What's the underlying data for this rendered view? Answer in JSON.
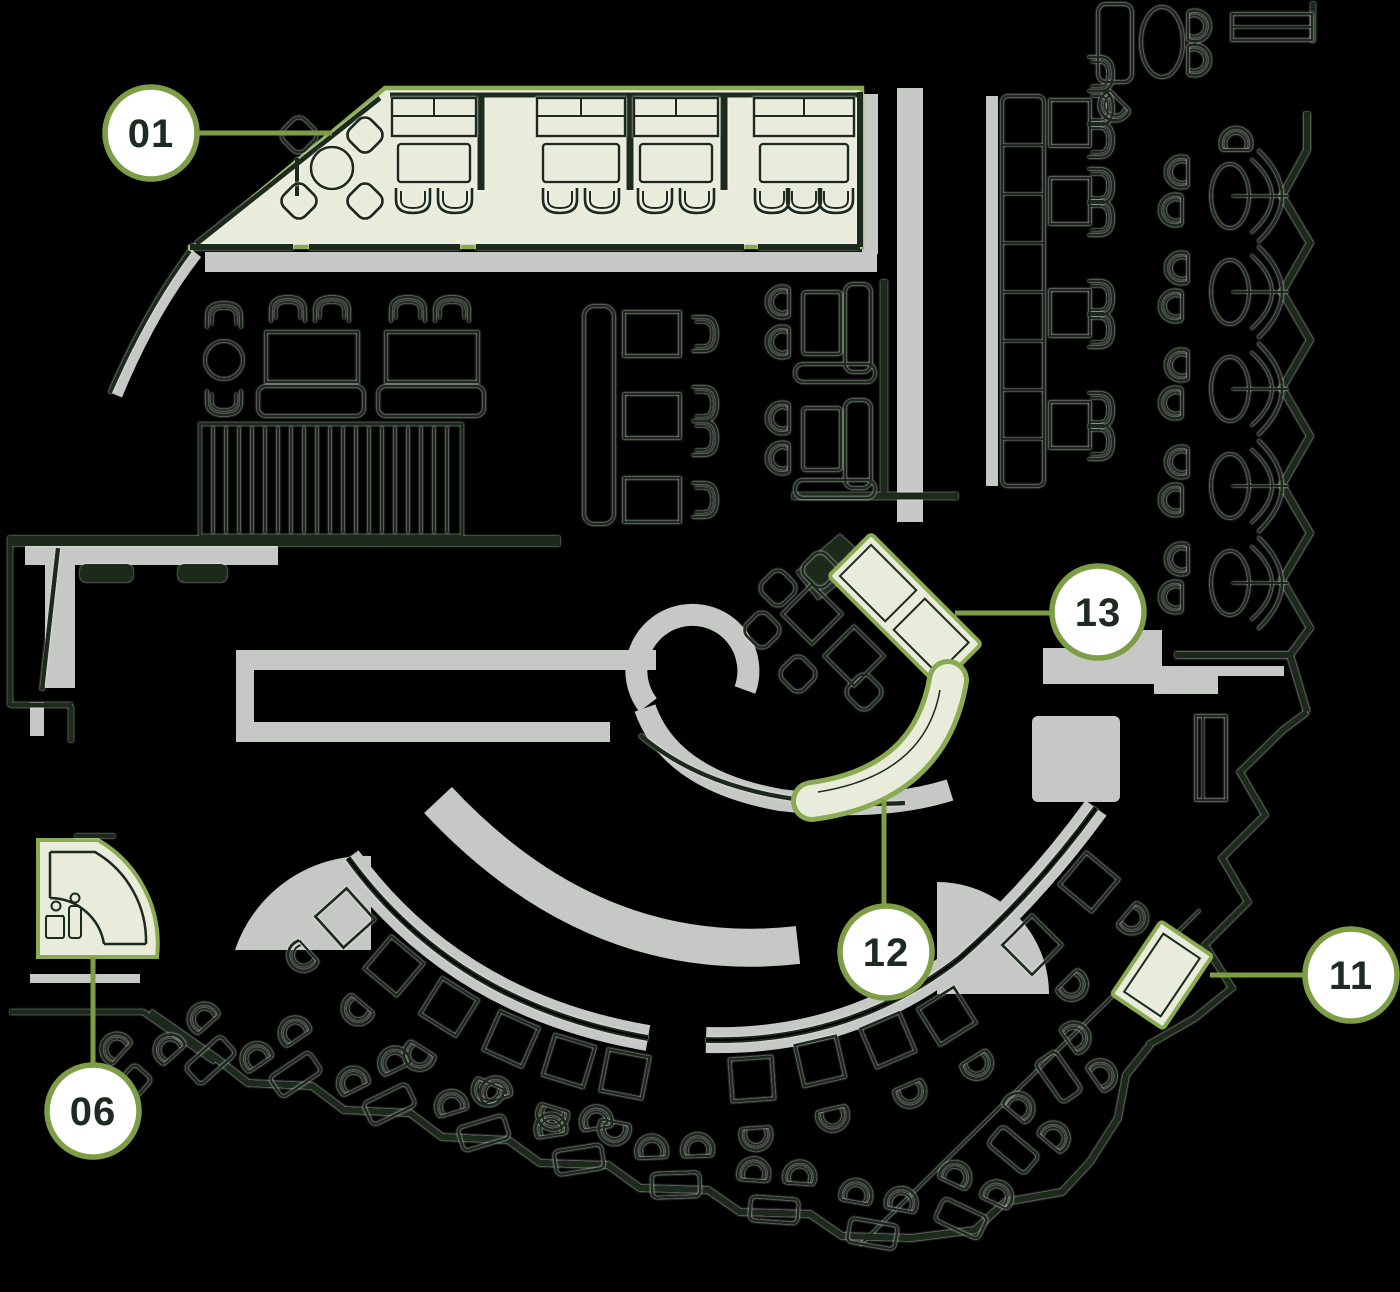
{
  "plan": {
    "title": "Restaurant floor plan with numbered zone markers",
    "background": "#000000"
  },
  "colors": {
    "line_dark": "#1b291f",
    "walkway_gray": "#c6c8c5",
    "highlight_fill": "#e9ecdb",
    "highlight_stroke": "#8aab52",
    "marker_stroke": "#7d9e44",
    "marker_fill": "#ffffff",
    "marker_text": "#1d2b22"
  },
  "callouts": [
    {
      "id": "01",
      "label": "01"
    },
    {
      "id": "06",
      "label": "06"
    },
    {
      "id": "11",
      "label": "11"
    },
    {
      "id": "12",
      "label": "12"
    },
    {
      "id": "13",
      "label": "13"
    }
  ],
  "icons": {
    "area06": "two-people-figures"
  }
}
